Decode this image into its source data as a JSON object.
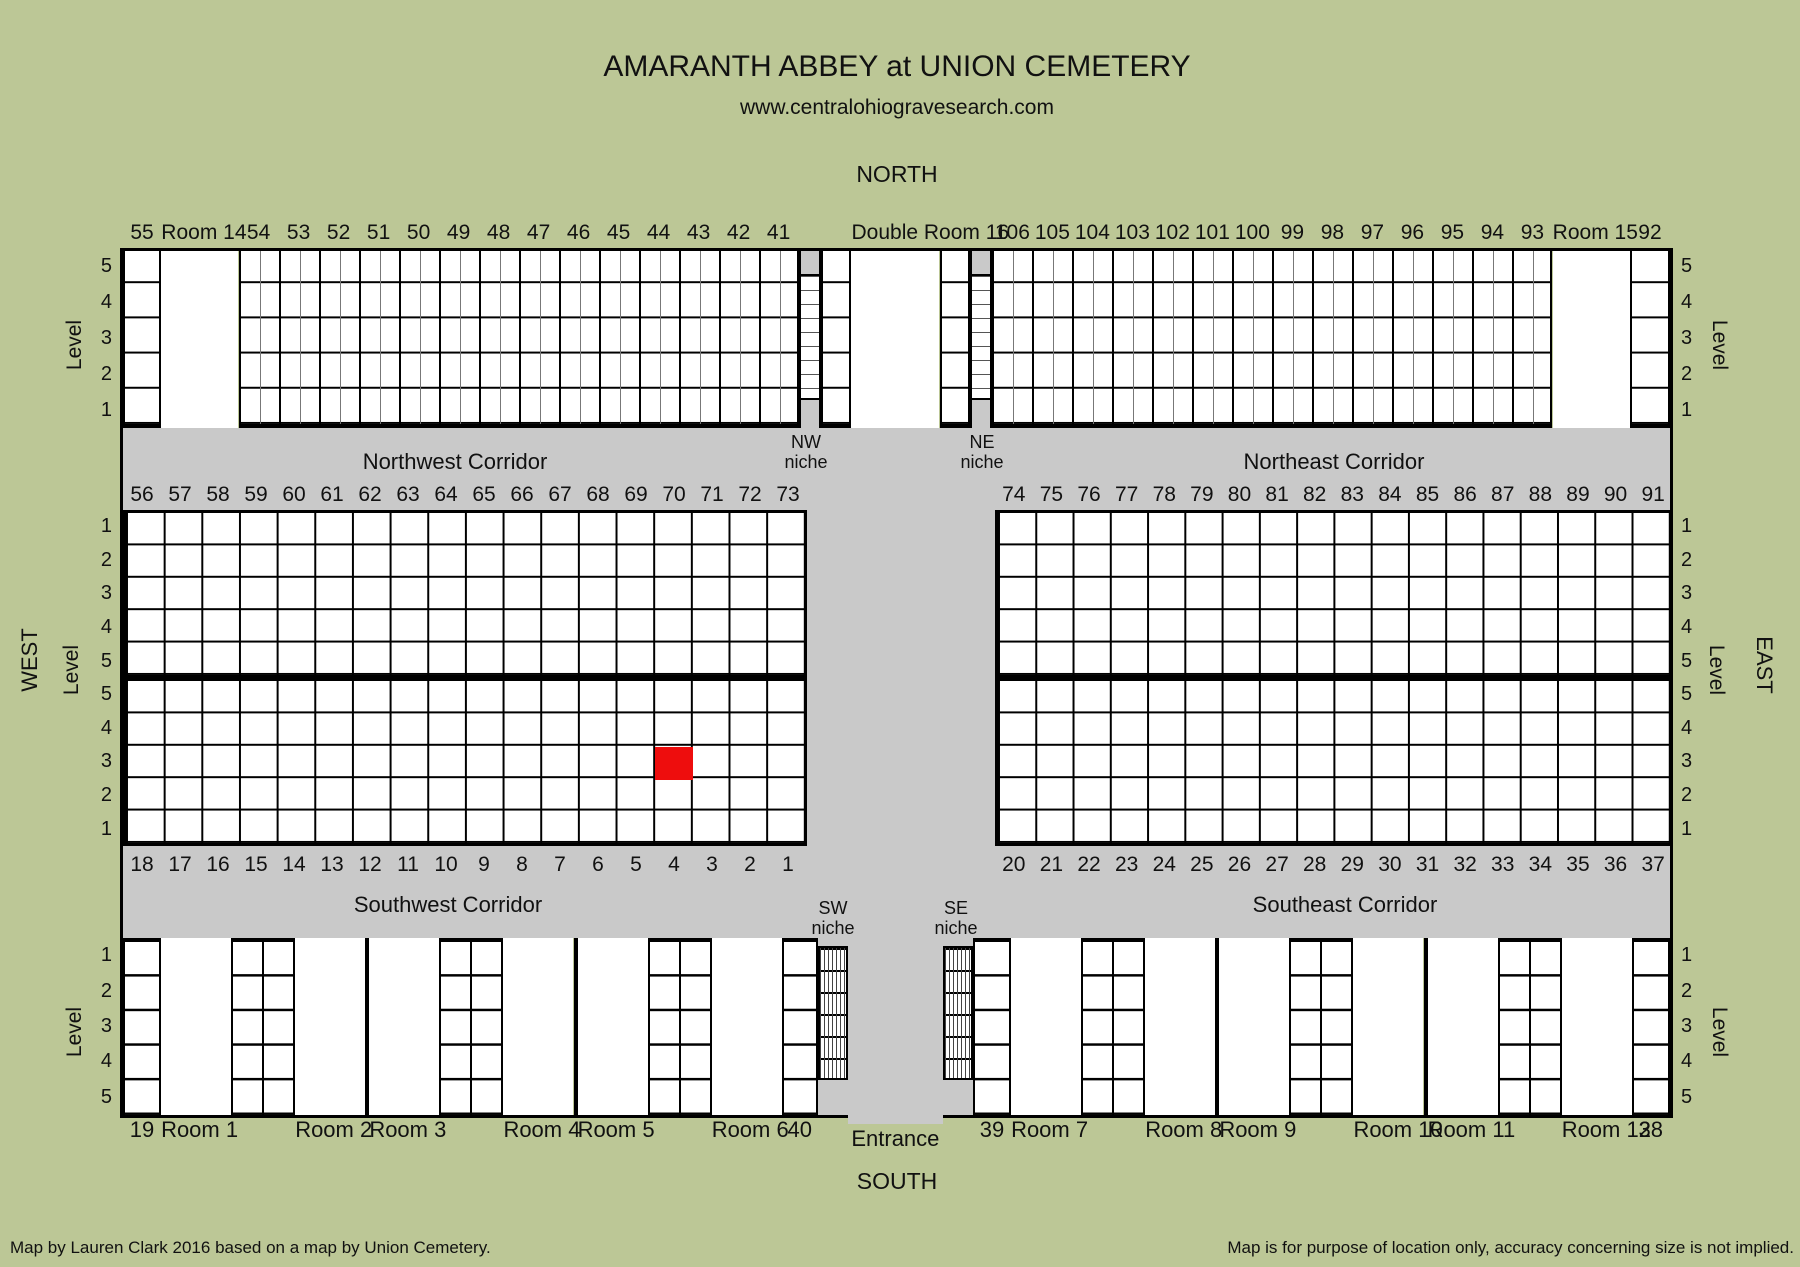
{
  "colors": {
    "background": "#bcc796",
    "corridor": "#c9c9c9",
    "highlight": "#ee0d0d",
    "line": "#000000"
  },
  "header": {
    "title": "AMARANTH ABBEY at UNION CEMETERY",
    "subtitle": "www.centralohiogravesearch.com"
  },
  "compass": {
    "north": "NORTH",
    "south": "SOUTH",
    "west": "WEST",
    "east": "EAST"
  },
  "level_label": "Level",
  "north_band": {
    "left_col": "55",
    "room_left": "Room 14",
    "cols_left": [
      "54",
      "53",
      "52",
      "51",
      "50",
      "49",
      "48",
      "47",
      "46",
      "45",
      "44",
      "43",
      "42",
      "41"
    ],
    "double_room": "Double Room 16",
    "nw_niche": [
      "NW",
      "niche"
    ],
    "ne_niche": [
      "NE",
      "niche"
    ],
    "cols_right": [
      "106",
      "105",
      "104",
      "103",
      "102",
      "101",
      "100",
      "99",
      "98",
      "97",
      "96",
      "95",
      "94",
      "93"
    ],
    "room_right": "Room 15",
    "right_col": "92",
    "levels": [
      "5",
      "4",
      "3",
      "2",
      "1"
    ]
  },
  "middle_band": {
    "nw_corridor": "Northwest Corridor",
    "ne_corridor": "Northeast Corridor",
    "nw_cols": [
      "56",
      "57",
      "58",
      "59",
      "60",
      "61",
      "62",
      "63",
      "64",
      "65",
      "66",
      "67",
      "68",
      "69",
      "70",
      "71",
      "72",
      "73"
    ],
    "ne_cols": [
      "74",
      "75",
      "76",
      "77",
      "78",
      "79",
      "80",
      "81",
      "82",
      "83",
      "84",
      "85",
      "86",
      "87",
      "88",
      "89",
      "90",
      "91"
    ],
    "levels_upper": [
      "1",
      "2",
      "3",
      "4",
      "5"
    ],
    "levels_lower": [
      "5",
      "4",
      "3",
      "2",
      "1"
    ],
    "nw_bottom_cols": [
      "18",
      "17",
      "16",
      "15",
      "14",
      "13",
      "12",
      "11",
      "10",
      "9",
      "8",
      "7",
      "6",
      "5",
      "4",
      "3",
      "2",
      "1"
    ],
    "ne_bottom_cols": [
      "20",
      "21",
      "22",
      "23",
      "24",
      "25",
      "26",
      "27",
      "28",
      "29",
      "30",
      "31",
      "32",
      "33",
      "34",
      "35",
      "36",
      "37"
    ],
    "highlight": {
      "column": "70",
      "level": "3"
    }
  },
  "south_band": {
    "sw_corridor": "Southwest Corridor",
    "se_corridor": "Southeast Corridor",
    "sw_niche": [
      "SW",
      "niche"
    ],
    "se_niche": [
      "SE",
      "niche"
    ],
    "left_col": "19",
    "rooms_left": [
      "Room 1",
      "Room 2",
      "Room 3",
      "Room 4",
      "Room 5",
      "Room 6"
    ],
    "entrance_left_col": "40",
    "entrance": "Entrance",
    "entrance_right_col": "39",
    "rooms_right": [
      "Room 7",
      "Room 8",
      "Room 9",
      "Room 10",
      "Room 11",
      "Room 12"
    ],
    "right_col": "38",
    "levels": [
      "1",
      "2",
      "3",
      "4",
      "5"
    ]
  },
  "footer": {
    "left": "Map by Lauren Clark 2016 based on a map by Union Cemetery.",
    "right": "Map is for purpose of location only, accuracy concerning size is not implied."
  }
}
